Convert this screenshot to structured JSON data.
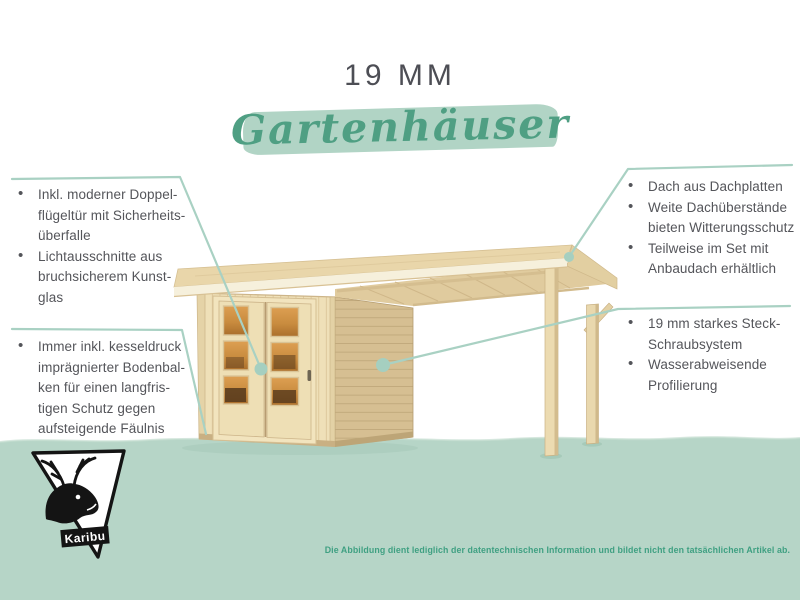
{
  "title": "19 MM",
  "script_title": "Gartenhäuser",
  "left_features": {
    "group1": [
      {
        "text": "Inkl. moderner Doppel-\nflügeltür mit Sicherheits-\nüberfalle"
      },
      {
        "text": "Lichtausschnitte aus\nbruchsicherem Kunst-\nglas"
      }
    ],
    "group2": [
      {
        "text": "Immer inkl. kesseldruck\nimprägnierter Bodenbal-\nken für einen langfris-\ntigen Schutz gegen\naufsteigende Fäulnis"
      }
    ]
  },
  "right_features": {
    "group1": [
      {
        "text": "Dach aus Dachplatten"
      },
      {
        "text": "Weite Dachüberstände\nbieten Witterungsschutz"
      },
      {
        "text": "Teilweise im Set mit\nAnbaudach erhältlich"
      }
    ],
    "group2": [
      {
        "text": "19 mm starkes Steck-\nSchraubsystem"
      },
      {
        "text": "Wasserabweisende\nProfilierung"
      }
    ]
  },
  "footer": {
    "disclaimer": "Die Abbildung dient lediglich der datentechnischen Information und bildet nicht den tatsächlichen Artikel ab.",
    "logo_text": "Karibu"
  },
  "colors": {
    "accent_green": "#4f9f83",
    "band_green": "#b6d5c7",
    "brush_green": "#b1d4c5",
    "connector_teal": "#a9d1c3",
    "text_gray": "#54555a",
    "title_gray": "#4d4e55",
    "disclaimer_green": "#3fa082",
    "wood_light": "#efe0b8",
    "wood_side": "#d6bf92",
    "window_amber": "#c98c3f"
  }
}
